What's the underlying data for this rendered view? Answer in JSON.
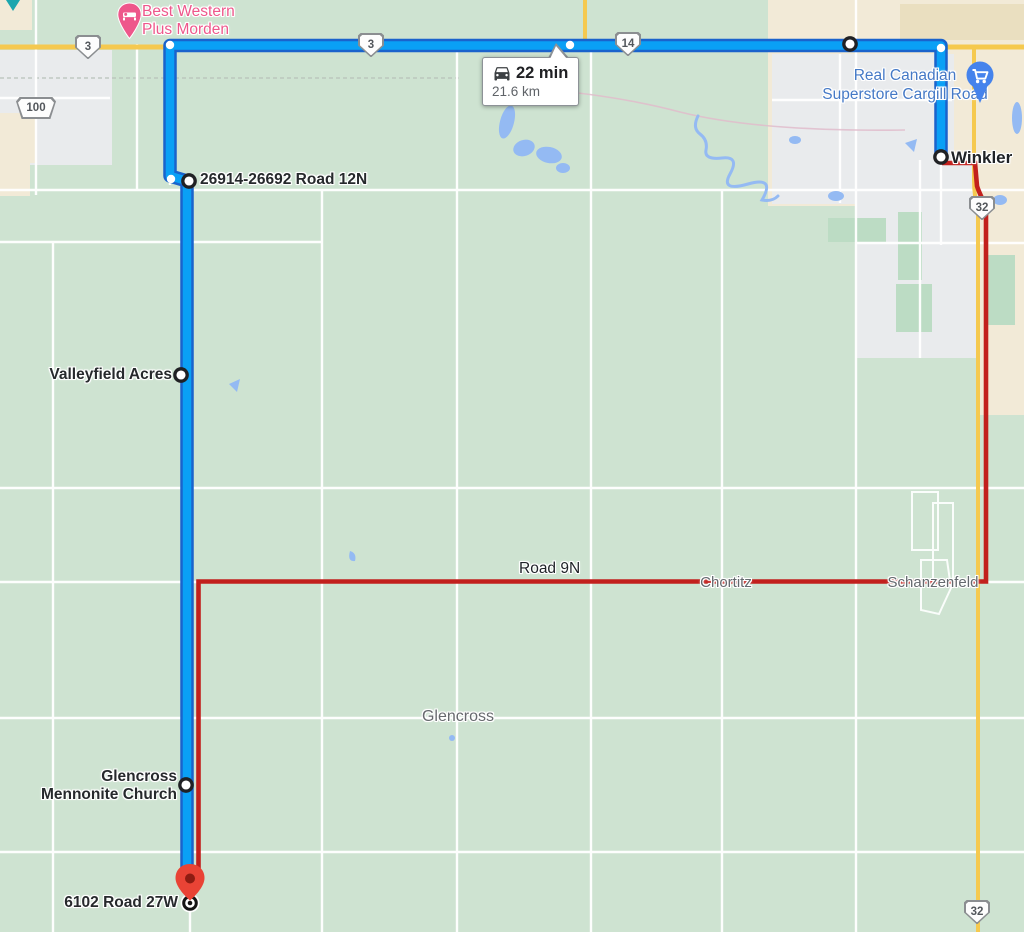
{
  "route_summary": {
    "duration": "22 min",
    "distance": "21.6 km"
  },
  "waypoint_labels": {
    "road12n": "26914-26692 Road 12N",
    "valleyfield": "Valleyfield Acres",
    "church_line1": "Glencross",
    "church_line2": "Mennonite Church",
    "destination": "6102 Road 27W",
    "winkler": "Winkler"
  },
  "poi_labels": {
    "hotel_line1": "Best Western",
    "hotel_line2": "Plus Morden",
    "store_line1": "Real Canadian",
    "store_line2": "Superstore Cargill Road"
  },
  "place_labels": {
    "road9n": "Road 9N",
    "chortitz": "Chortitz",
    "schanzenfeld": "Schanzenfeld",
    "glencross": "Glencross"
  },
  "highway_shields": {
    "hwy3_west": "3",
    "hwy3_mid": "3",
    "hwy14": "14",
    "hwy100": "100",
    "hwy32_north": "32",
    "hwy32_south": "32"
  },
  "colors": {
    "map_background": "#cee3d1",
    "route_primary": "#0aa0f5",
    "route_primary_border": "#1a63cc",
    "route_alternate": "#c2201d",
    "highway_yellow": "#f5c94f",
    "water": "#94baf3",
    "urban_gray": "#e9ebed",
    "urban_beige": "#f2ead7",
    "hotel_pin": "#ee578b",
    "store_pin": "#4583ec",
    "destination_pin": "#e94335"
  }
}
